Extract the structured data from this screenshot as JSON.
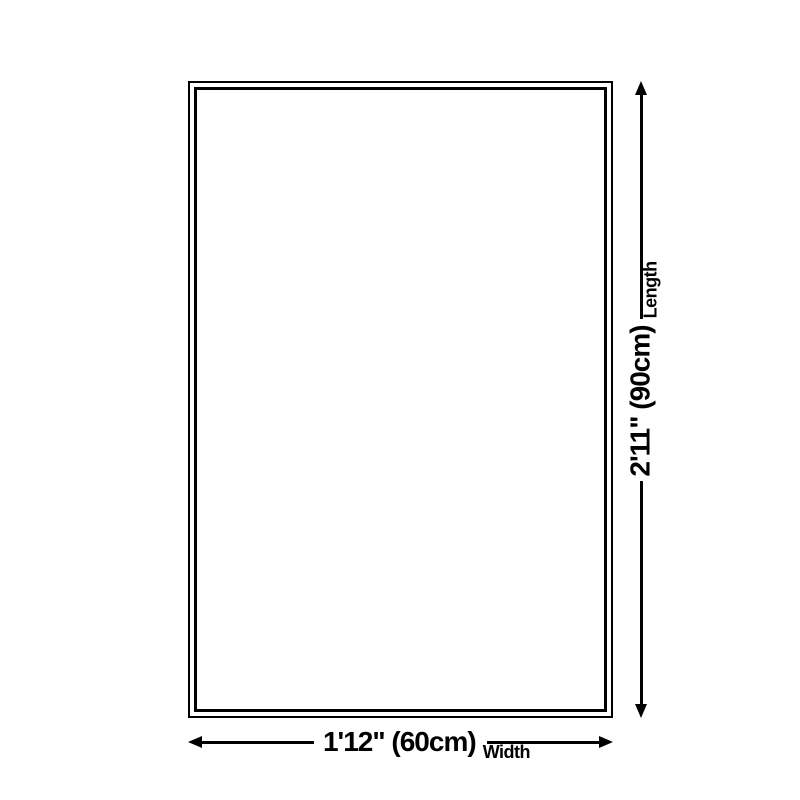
{
  "diagram": {
    "colors": {
      "line": "#000000",
      "bg": "#ffffff",
      "text": "#000000"
    },
    "length": {
      "value": "2'11\" (90cm)",
      "label": "Length"
    },
    "width": {
      "value": "1'12\" (60cm)",
      "label": "Width"
    }
  }
}
